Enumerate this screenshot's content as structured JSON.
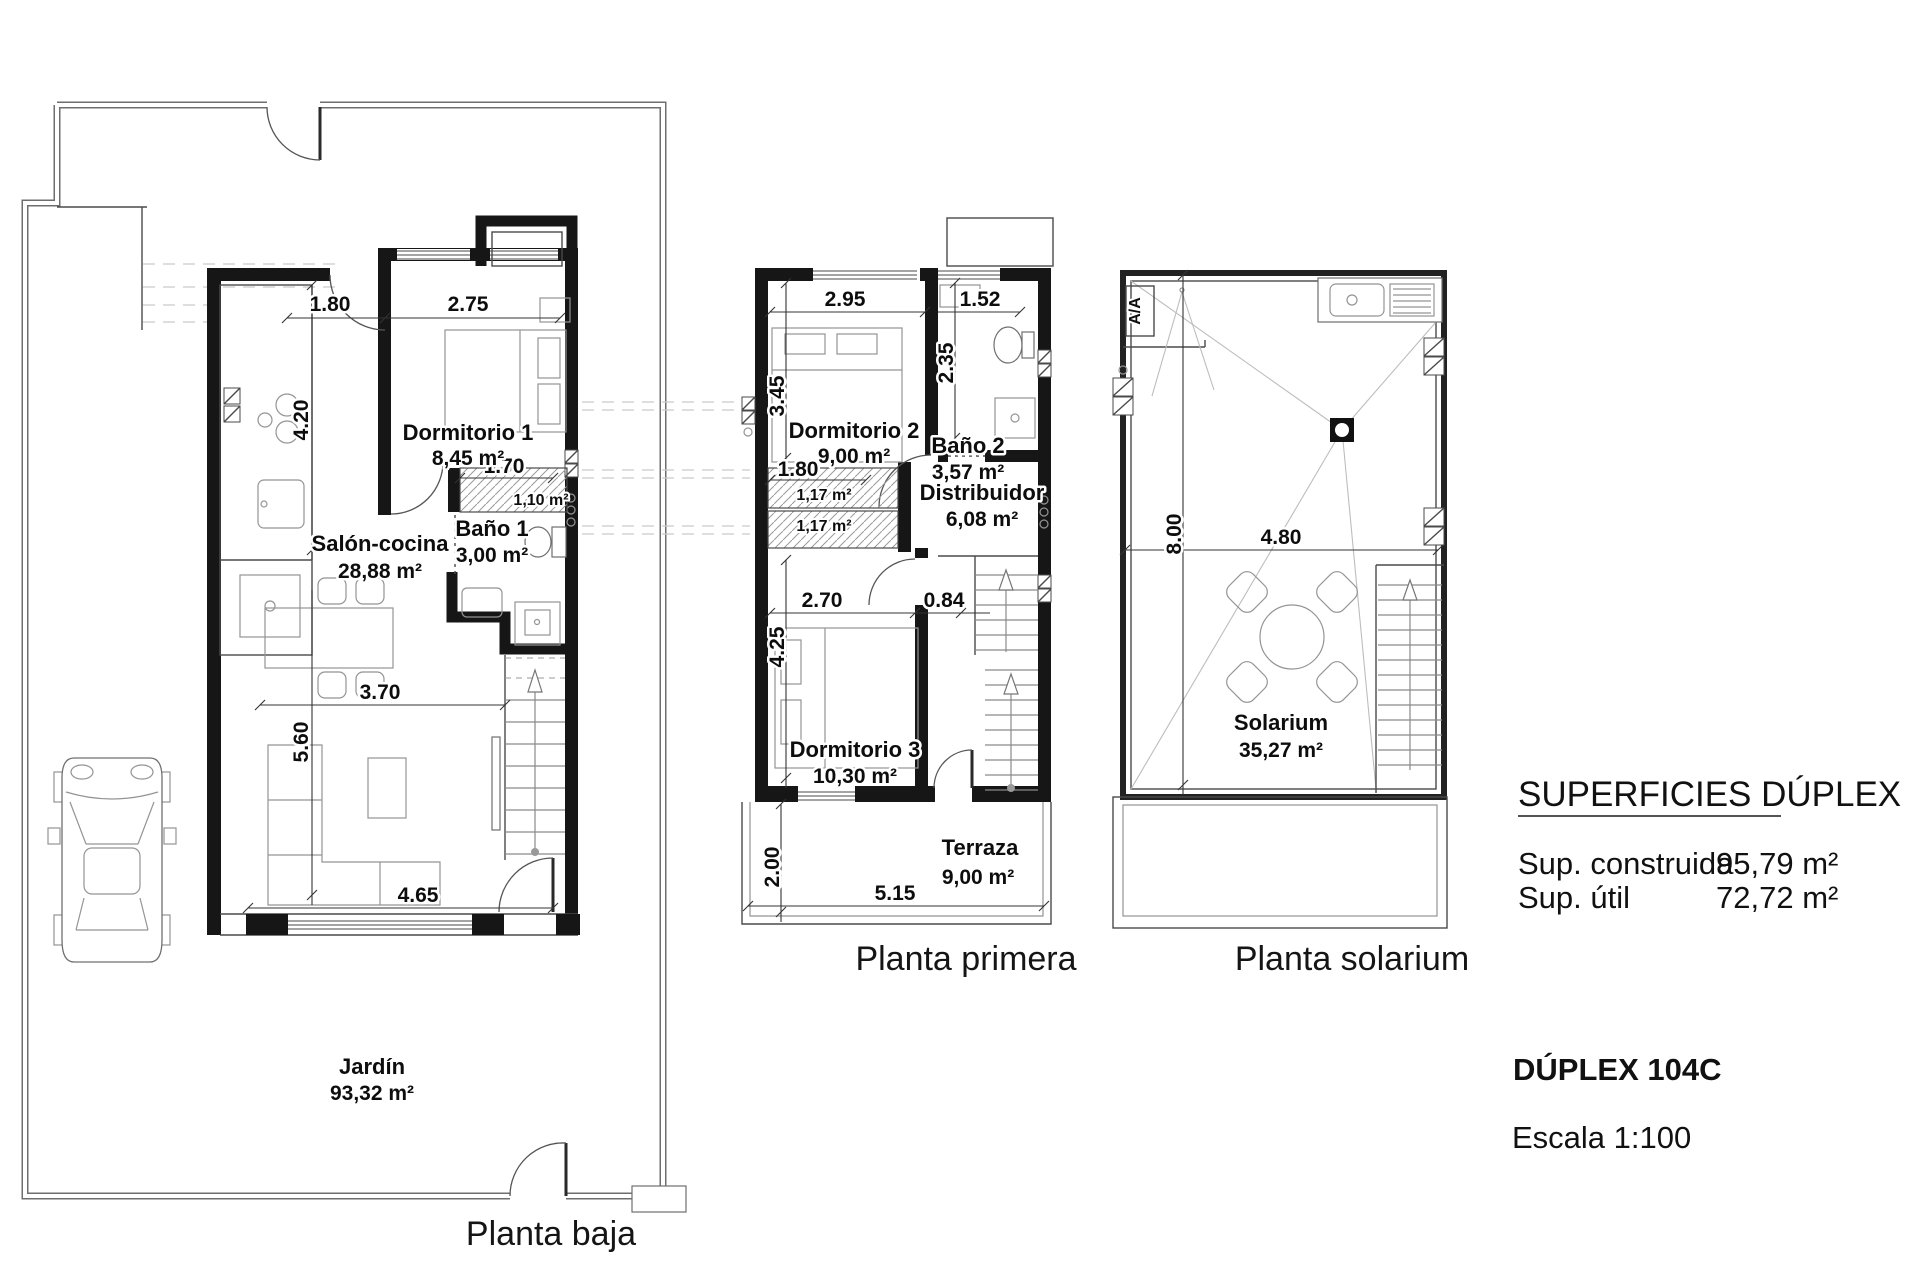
{
  "baja": {
    "title": "Planta baja",
    "rooms": {
      "salon": {
        "name": "Salón-cocina",
        "area": "28,88 m²"
      },
      "dorm1": {
        "name": "Dormitorio 1",
        "area": "8,45 m²"
      },
      "bano1": {
        "name": "Baño 1",
        "area": "3,00 m²"
      },
      "armario_area": "1,10 m²",
      "jardin": {
        "name": "Jardín",
        "area": "93,32 m²"
      }
    },
    "dims": {
      "w_door": "1.80",
      "w_dorm1": "2.75",
      "h_kitchen": "4.20",
      "w_armario": "1.70",
      "w_salon": "3.70",
      "h_salon": "5.60",
      "w_bottom": "4.65"
    }
  },
  "primera": {
    "title": "Planta primera",
    "rooms": {
      "dorm2": {
        "name": "Dormitorio 2",
        "area": "9,00 m²"
      },
      "bano2": {
        "name": "Baño 2",
        "area": "3,57 m²"
      },
      "distribuidor": {
        "name": "Distribuidor",
        "area": "6,08 m²"
      },
      "dorm3": {
        "name": "Dormitorio 3",
        "area": "10,30 m²"
      },
      "terraza": {
        "name": "Terraza",
        "area": "9,00 m²"
      },
      "armario1_area": "1,17 m²",
      "armario2_area": "1,17 m²"
    },
    "dims": {
      "w_dorm2": "2.95",
      "w_bano2": "1.52",
      "h_dorm2": "3.45",
      "h_bano2": "2.35",
      "w_armario": "1.80",
      "w_dorm3": "2.70",
      "w_hall": "0.84",
      "h_dorm3": "4.25",
      "h_terraza": "2.00",
      "w_terraza": "5.15"
    }
  },
  "solarium": {
    "title": "Planta solarium",
    "rooms": {
      "solarium": {
        "name": "Solarium",
        "area": "35,27 m²"
      }
    },
    "dims": {
      "h": "8.00",
      "w": "4.80"
    },
    "ac_label": "A/A"
  },
  "info": {
    "heading": "SUPERFICIES DÚPLEX",
    "construida_label": "Sup. construida",
    "construida_value": "95,79 m²",
    "util_label": "Sup. útil",
    "util_value": "72,72 m²",
    "model": "DÚPLEX 104C",
    "scale": "Escala 1:100"
  }
}
